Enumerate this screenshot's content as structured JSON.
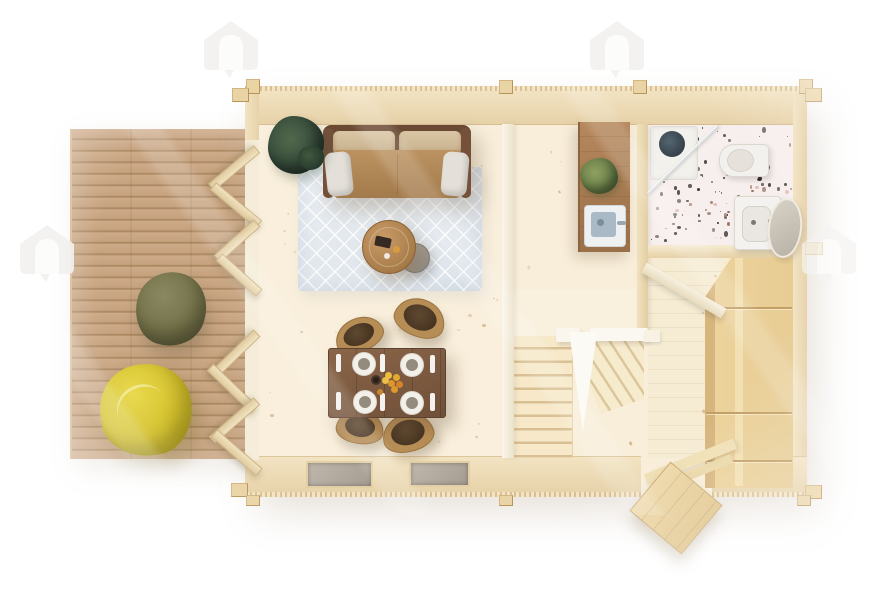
{
  "scene": {
    "type": "3d-rendered-floor-plan",
    "subject": "timber-log-cabin-with-terrace",
    "view": "top-down",
    "background_color": "#ffffff",
    "visible_text": "none"
  },
  "watermark": {
    "icon": "house-arch-logo",
    "count": 4,
    "color": "#f2f1ef"
  },
  "palette": {
    "deck_wood": "#c7a583",
    "wall_wood": "#ecd9b4",
    "floor_spruce": "#f8efdc",
    "plywood_counter": "#a97f55",
    "cabinet_wood": "#e9cd96",
    "sofa_leather": "#b98e5f",
    "sofa_back": "#6a4a32",
    "rug_blue": "#e2e8ed",
    "dining_table": "#7a5940",
    "beanbag_olive": "#6f6d45",
    "beanbag_yellow": "#d3c02c",
    "terrazzo_base": "#f7efed",
    "stair_tread": "#f3e4c3",
    "railing_white": "#fbf8f1",
    "window_glass": "#b3aaa0",
    "plant_green": "#3c5340",
    "door_wood": "#e8d4a5"
  },
  "textures": {
    "terrazzo_speckles": {
      "colors": [
        "#2f2a28",
        "#95705c",
        "#d3a79a",
        "#6b6560"
      ],
      "count": 130
    },
    "floor_knots": {
      "color": "#b98a52",
      "count": 70
    }
  },
  "rooms": [
    {
      "id": "terrace",
      "furniture": [
        "beanbag-olive",
        "beanbag-yellow",
        "bifold-doors"
      ]
    },
    {
      "id": "living-room",
      "furniture": [
        "sofa",
        "rug",
        "coffee-table",
        "side-table",
        "potted-plant"
      ]
    },
    {
      "id": "dining-area",
      "furniture": [
        "dining-table",
        "chair-x4",
        "place-setting-x4",
        "fruit-bowl"
      ]
    },
    {
      "id": "kitchenette-hall",
      "furniture": [
        "plywood-counter",
        "sink",
        "plant"
      ]
    },
    {
      "id": "bathroom",
      "furniture": [
        "shower",
        "glass-screen",
        "toilet",
        "washbasin",
        "mirror"
      ]
    },
    {
      "id": "staircase",
      "furniture": [
        "straight-flight",
        "winder-flight",
        "white-railing"
      ]
    },
    {
      "id": "utility-room",
      "furniture": [
        "tall-cabinet",
        "under-stair-panel",
        "entrance-door"
      ]
    }
  ]
}
